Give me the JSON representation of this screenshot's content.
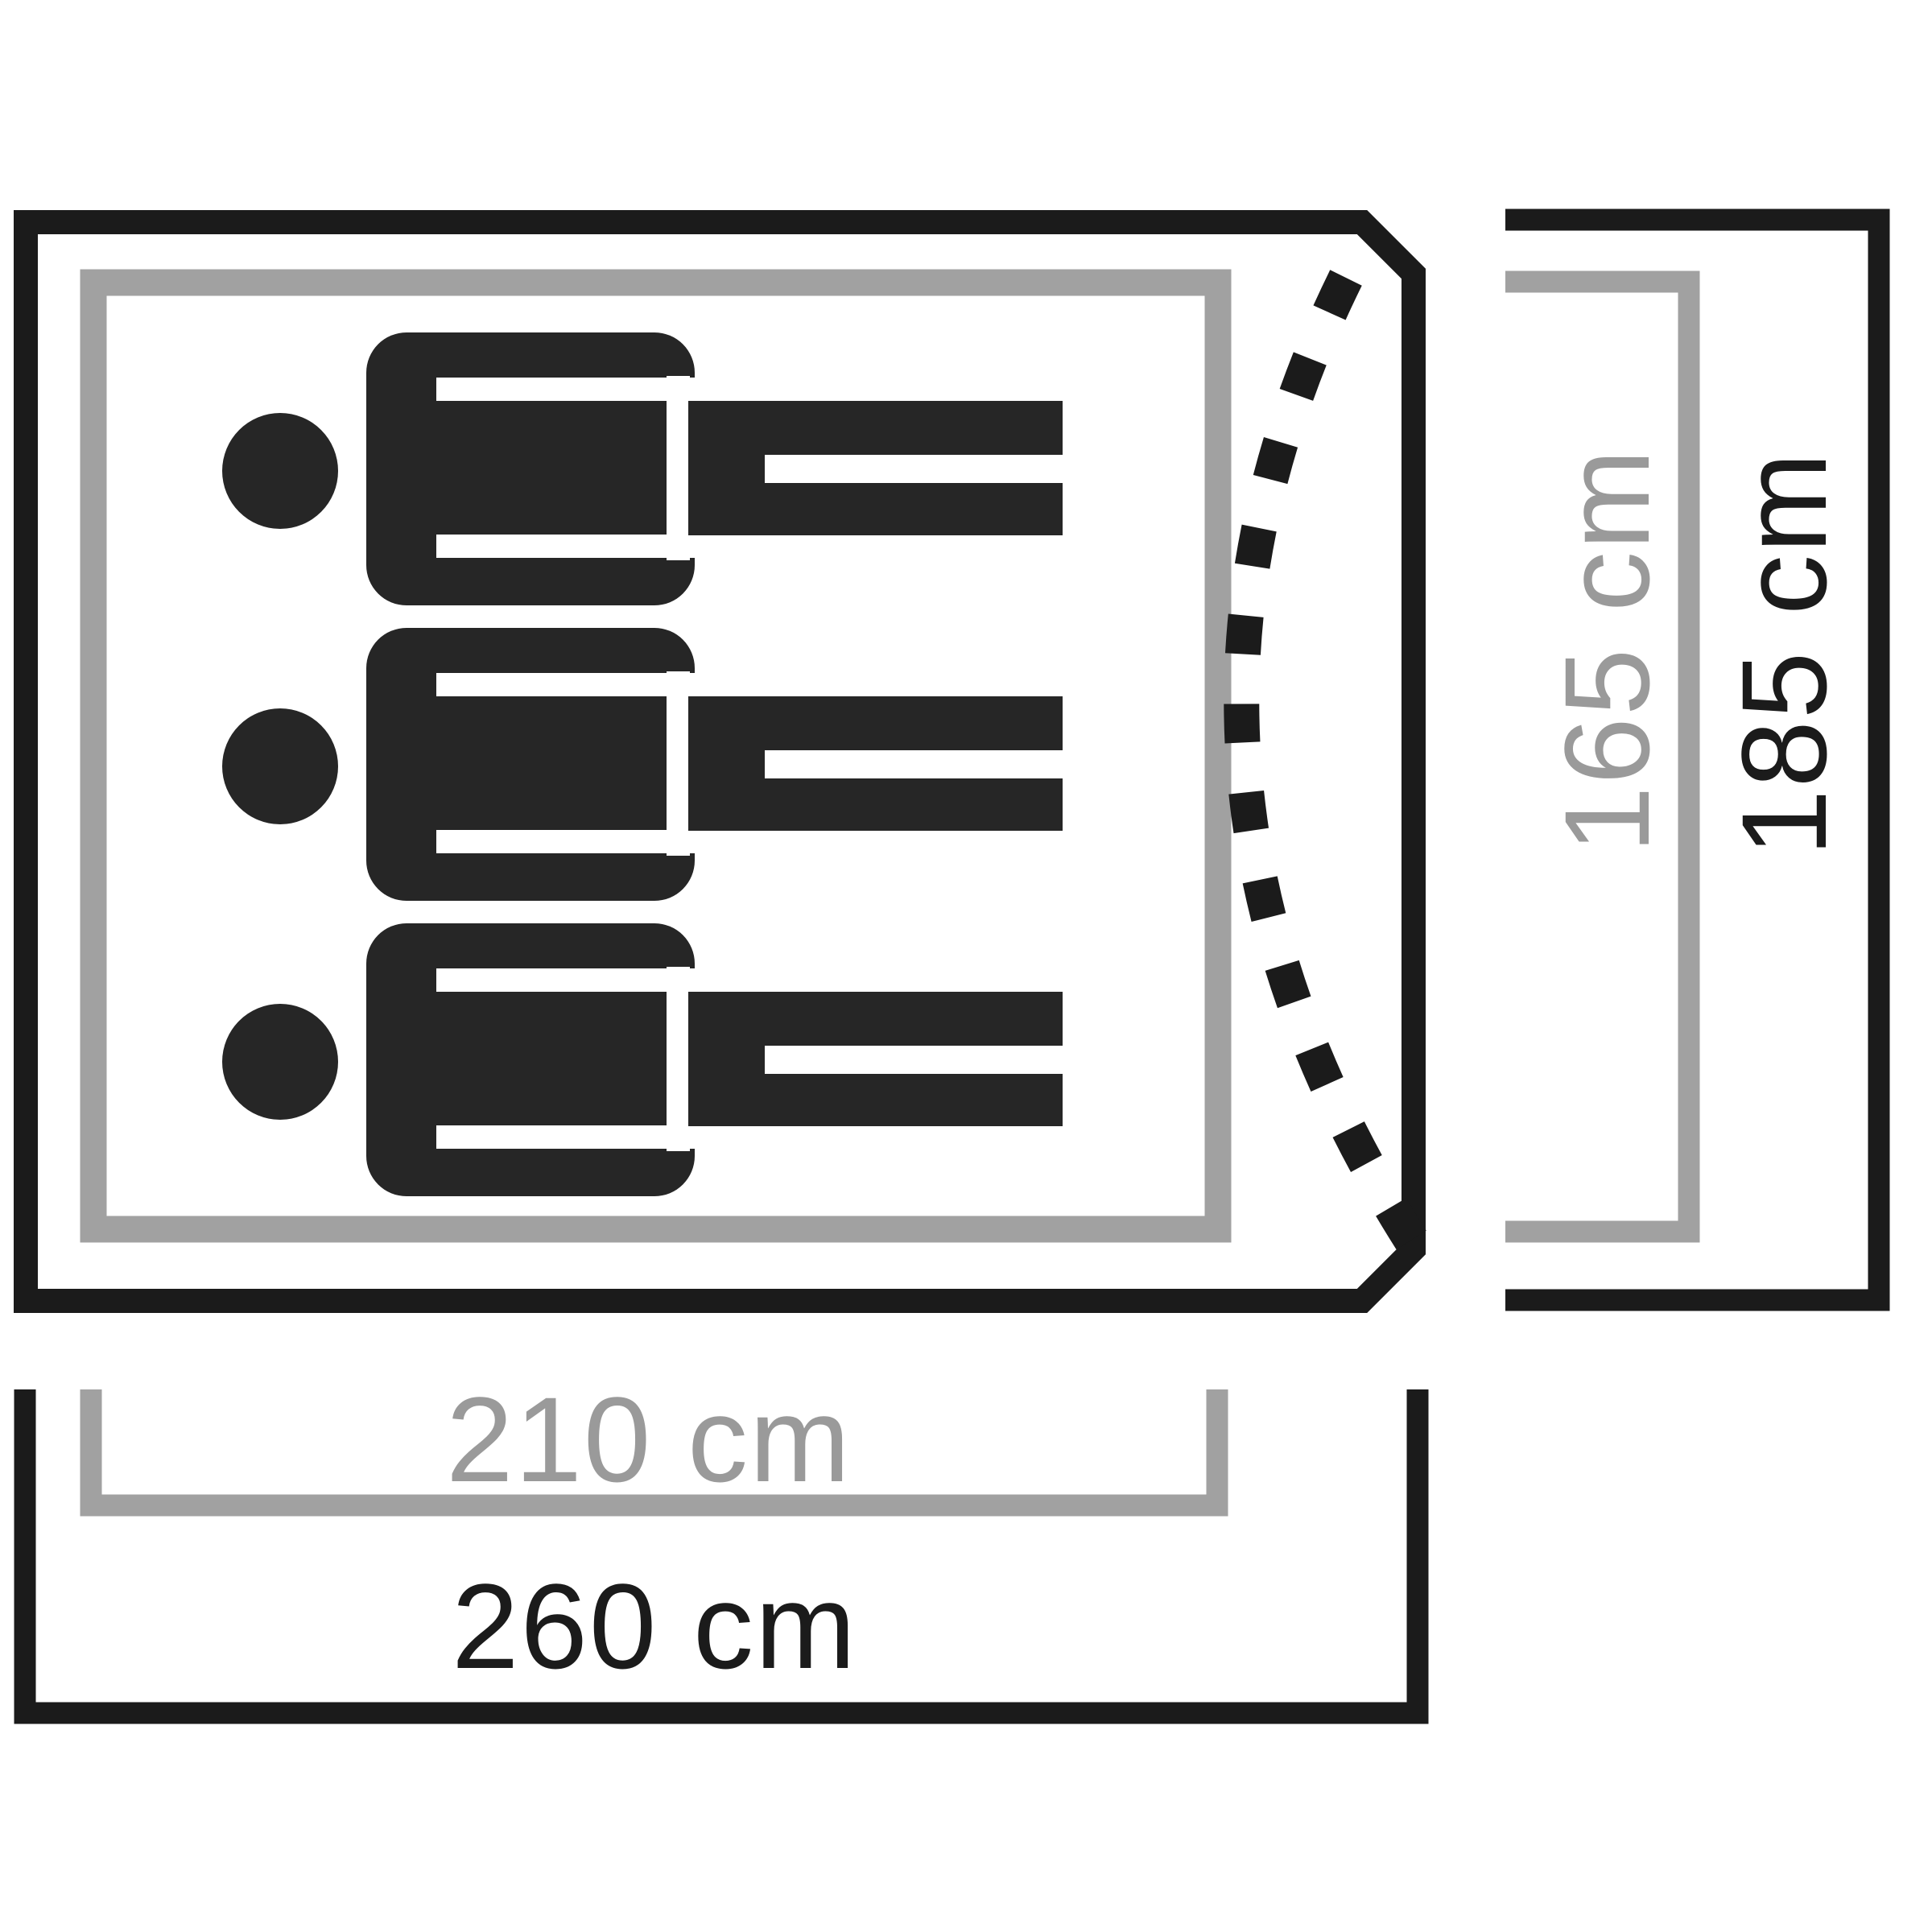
{
  "diagram": {
    "type": "tent-floorplan-top-view",
    "figures": {
      "icon": "person-lying-icon",
      "count": 3,
      "row_spacing": 367
    },
    "measurements": {
      "inner_width": {
        "label": "210 cm",
        "kind": "inner"
      },
      "outer_width": {
        "label": "260 cm",
        "kind": "outer"
      },
      "inner_depth": {
        "label": "165 cm",
        "kind": "inner"
      },
      "outer_depth": {
        "label": "185 cm",
        "kind": "outer"
      }
    },
    "colors": {
      "outer": "#1b1b1b",
      "inner": "#a1a1a1",
      "inner_text": "#9a9a9a",
      "figure": "#262626",
      "background": "#ffffff"
    }
  }
}
